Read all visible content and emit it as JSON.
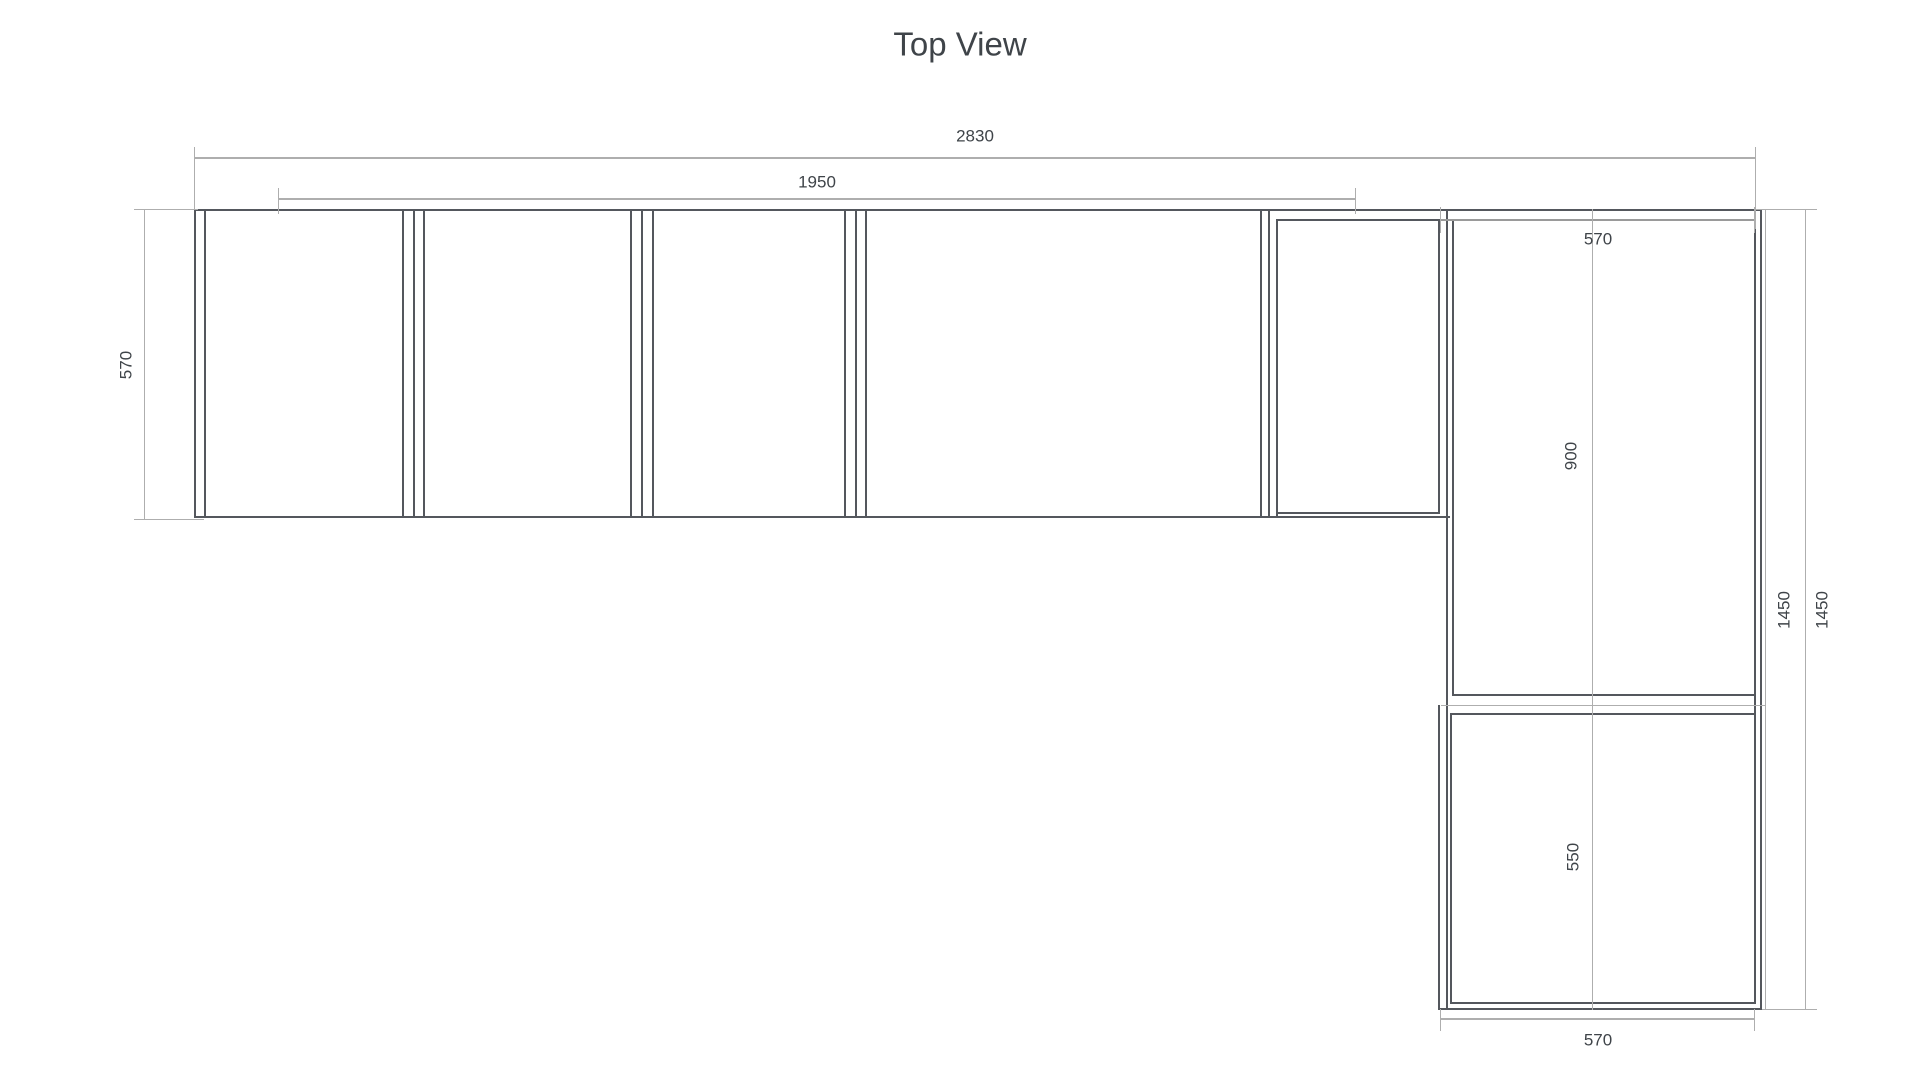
{
  "title": "Top View",
  "labels": {
    "overall_width": "2830",
    "run_width": "1950",
    "left_depth": "570",
    "right_width_top": "570",
    "upper_section": "900",
    "lower_section": "550",
    "total_height_a": "1450",
    "total_height_b": "1450",
    "right_width_bottom": "570"
  },
  "colors": {
    "background": "#ffffff",
    "cabinet_line": "#54575d",
    "dimension_line": "#aeaeae",
    "dimension_line_dark": "#9a9a9a",
    "label_text": "#3f4449"
  }
}
